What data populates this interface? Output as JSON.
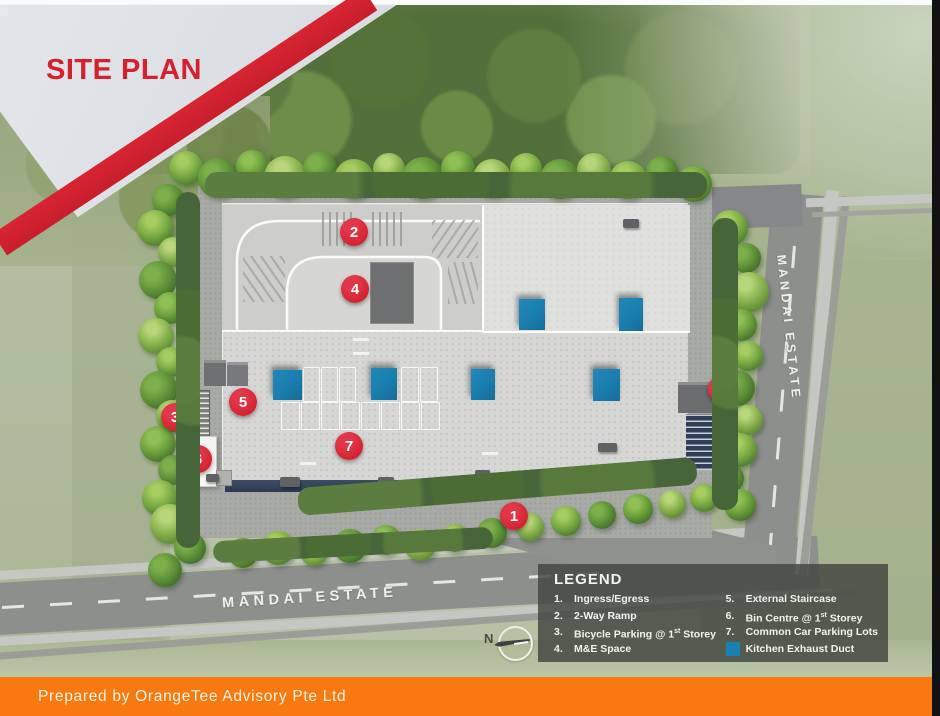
{
  "banner": {
    "title": "SITE PLAN"
  },
  "roads": {
    "bottom_label": "MANDAI ESTATE",
    "right_label": "MANDAI ESTATE"
  },
  "compass": {
    "label": "N"
  },
  "legend": {
    "title": "LEGEND",
    "swatch_color": "#1a80b4",
    "columns": [
      {
        "items": [
          {
            "no": "1.",
            "label": "Ingress/Egress"
          },
          {
            "no": "2.",
            "label": "2-Way Ramp"
          },
          {
            "no": "3.",
            "label": "Bicycle Parking @ 1st Storey"
          },
          {
            "no": "4.",
            "label": "M&E Space"
          }
        ]
      },
      {
        "items": [
          {
            "no": "5.",
            "label": "External Staircase"
          },
          {
            "no": "6.",
            "label": "Bin Centre @ 1st Storey"
          },
          {
            "no": "7.",
            "label": "Common Car Parking Lots"
          },
          {
            "swatch": true,
            "label": "Kitchen Exhaust Duct"
          }
        ]
      }
    ]
  },
  "footer": {
    "text": "Prepared by OrangeTee Advisory Pte Ltd"
  },
  "colors": {
    "brand_red": "#d5202d",
    "brand_orange": "#f8790f",
    "marker_red": "#d62330",
    "duct_blue": "#1a80b4"
  },
  "site": {
    "markers": [
      {
        "n": "2",
        "x": 354,
        "y": 232
      },
      {
        "n": "4",
        "x": 355,
        "y": 289
      },
      {
        "n": "5",
        "x": 243,
        "y": 402
      },
      {
        "n": "3",
        "x": 175,
        "y": 417
      },
      {
        "n": "6",
        "x": 198,
        "y": 459
      },
      {
        "n": "7",
        "x": 349,
        "y": 446
      },
      {
        "n": "5",
        "x": 722,
        "y": 389
      },
      {
        "n": "1",
        "x": 514,
        "y": 516
      }
    ],
    "ducts": [
      {
        "x": 519,
        "y": 299,
        "w": 26,
        "h": 31
      },
      {
        "x": 619,
        "y": 298,
        "w": 24,
        "h": 33
      },
      {
        "x": 273,
        "y": 370,
        "w": 29,
        "h": 30
      },
      {
        "x": 371,
        "y": 368,
        "w": 26,
        "h": 32
      },
      {
        "x": 471,
        "y": 369,
        "w": 24,
        "h": 31
      },
      {
        "x": 593,
        "y": 369,
        "w": 27,
        "h": 32
      }
    ],
    "vents": [
      [
        280,
        477,
        20,
        10
      ],
      [
        378,
        477,
        16,
        9
      ],
      [
        475,
        470,
        15,
        9
      ],
      [
        598,
        443,
        19,
        9
      ],
      [
        623,
        219,
        16,
        9
      ],
      [
        206,
        474,
        13,
        8
      ]
    ],
    "parking_rows": [
      {
        "x": 303,
        "y": 367,
        "cells": 3,
        "cw": 18,
        "ch": 33
      },
      {
        "x": 401,
        "y": 367,
        "cells": 2,
        "cw": 19,
        "ch": 33
      },
      {
        "x": 281,
        "y": 402,
        "cells": 8,
        "cw": 20,
        "ch": 26
      }
    ],
    "trees": [
      [
        186,
        168,
        17,
        1
      ],
      [
        218,
        178,
        20,
        2
      ],
      [
        252,
        166,
        16,
        0
      ],
      [
        285,
        177,
        21,
        3
      ],
      [
        320,
        168,
        17,
        2
      ],
      [
        354,
        179,
        20,
        1
      ],
      [
        389,
        169,
        16,
        3
      ],
      [
        423,
        178,
        21,
        2
      ],
      [
        458,
        168,
        17,
        0
      ],
      [
        492,
        178,
        19,
        3
      ],
      [
        526,
        169,
        16,
        1
      ],
      [
        560,
        179,
        20,
        2
      ],
      [
        594,
        170,
        17,
        3
      ],
      [
        628,
        180,
        19,
        1
      ],
      [
        662,
        172,
        16,
        2
      ],
      [
        694,
        184,
        18,
        0
      ],
      [
        168,
        200,
        16,
        2
      ],
      [
        155,
        228,
        18,
        1
      ],
      [
        173,
        252,
        15,
        3
      ],
      [
        158,
        280,
        19,
        2
      ],
      [
        170,
        308,
        16,
        0
      ],
      [
        156,
        336,
        18,
        3
      ],
      [
        171,
        362,
        15,
        1
      ],
      [
        159,
        390,
        19,
        2
      ],
      [
        172,
        416,
        16,
        3
      ],
      [
        158,
        444,
        18,
        0
      ],
      [
        173,
        470,
        15,
        2
      ],
      [
        160,
        498,
        18,
        1
      ],
      [
        170,
        524,
        20,
        3
      ],
      [
        190,
        548,
        16,
        2
      ],
      [
        165,
        570,
        17,
        2
      ],
      [
        730,
        228,
        18,
        1
      ],
      [
        746,
        258,
        15,
        2
      ],
      [
        749,
        292,
        20,
        3
      ],
      [
        741,
        325,
        16,
        0
      ],
      [
        748,
        356,
        15,
        1
      ],
      [
        737,
        388,
        18,
        2
      ],
      [
        748,
        420,
        15,
        3
      ],
      [
        740,
        450,
        17,
        1
      ],
      [
        729,
        478,
        15,
        2
      ],
      [
        740,
        505,
        16,
        0
      ],
      [
        243,
        553,
        15,
        2
      ],
      [
        278,
        548,
        17,
        1
      ],
      [
        314,
        552,
        14,
        3
      ],
      [
        350,
        546,
        17,
        2
      ],
      [
        386,
        540,
        15,
        0
      ],
      [
        420,
        545,
        16,
        3
      ],
      [
        455,
        538,
        14,
        1
      ],
      [
        492,
        533,
        15,
        2
      ],
      [
        530,
        527,
        14,
        3
      ],
      [
        566,
        521,
        15,
        1
      ],
      [
        602,
        515,
        14,
        2
      ],
      [
        638,
        509,
        15,
        0
      ],
      [
        672,
        504,
        14,
        3
      ],
      [
        704,
        498,
        14,
        1
      ]
    ]
  }
}
